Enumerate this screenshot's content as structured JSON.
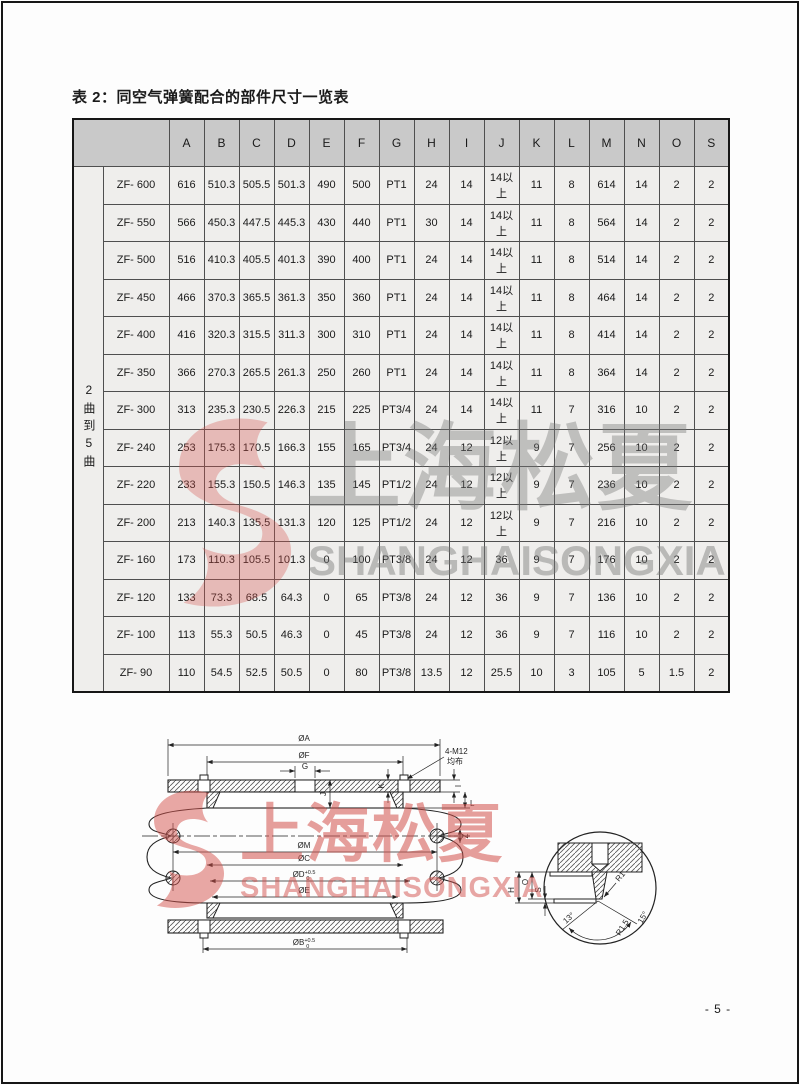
{
  "page": {
    "title": "表 2：同空气弹簧配合的部件尺寸一览表",
    "page_number": "- 5 -"
  },
  "table": {
    "row_group_label": "2曲到5曲",
    "columns": [
      "A",
      "B",
      "C",
      "D",
      "E",
      "F",
      "G",
      "H",
      "I",
      "J",
      "K",
      "L",
      "M",
      "N",
      "O",
      "S"
    ],
    "rows": [
      {
        "model": "ZF- 600",
        "values": [
          "616",
          "510.3",
          "505.5",
          "501.3",
          "490",
          "500",
          "PT1",
          "24",
          "14",
          "14以上",
          "11",
          "8",
          "614",
          "14",
          "2",
          "2"
        ]
      },
      {
        "model": "ZF- 550",
        "values": [
          "566",
          "450.3",
          "447.5",
          "445.3",
          "430",
          "440",
          "PT1",
          "30",
          "14",
          "14以上",
          "11",
          "8",
          "564",
          "14",
          "2",
          "2"
        ]
      },
      {
        "model": "ZF- 500",
        "values": [
          "516",
          "410.3",
          "405.5",
          "401.3",
          "390",
          "400",
          "PT1",
          "24",
          "14",
          "14以上",
          "11",
          "8",
          "514",
          "14",
          "2",
          "2"
        ]
      },
      {
        "model": "ZF- 450",
        "values": [
          "466",
          "370.3",
          "365.5",
          "361.3",
          "350",
          "360",
          "PT1",
          "24",
          "14",
          "14以上",
          "11",
          "8",
          "464",
          "14",
          "2",
          "2"
        ]
      },
      {
        "model": "ZF- 400",
        "values": [
          "416",
          "320.3",
          "315.5",
          "311.3",
          "300",
          "310",
          "PT1",
          "24",
          "14",
          "14以上",
          "11",
          "8",
          "414",
          "14",
          "2",
          "2"
        ]
      },
      {
        "model": "ZF- 350",
        "values": [
          "366",
          "270.3",
          "265.5",
          "261.3",
          "250",
          "260",
          "PT1",
          "24",
          "14",
          "14以上",
          "11",
          "8",
          "364",
          "14",
          "2",
          "2"
        ]
      },
      {
        "model": "ZF- 300",
        "values": [
          "313",
          "235.3",
          "230.5",
          "226.3",
          "215",
          "225",
          "PT3/4",
          "24",
          "14",
          "14以上",
          "11",
          "7",
          "316",
          "10",
          "2",
          "2"
        ]
      },
      {
        "model": "ZF- 240",
        "values": [
          "253",
          "175.3",
          "170.5",
          "166.3",
          "155",
          "165",
          "PT3/4",
          "24",
          "12",
          "12以上",
          "9",
          "7",
          "256",
          "10",
          "2",
          "2"
        ]
      },
      {
        "model": "ZF- 220",
        "values": [
          "233",
          "155.3",
          "150.5",
          "146.3",
          "135",
          "145",
          "PT1/2",
          "24",
          "12",
          "12以上",
          "9",
          "7",
          "236",
          "10",
          "2",
          "2"
        ]
      },
      {
        "model": "ZF- 200",
        "values": [
          "213",
          "140.3",
          "135.5",
          "131.3",
          "120",
          "125",
          "PT1/2",
          "24",
          "12",
          "12以上",
          "9",
          "7",
          "216",
          "10",
          "2",
          "2"
        ]
      },
      {
        "model": "ZF- 160",
        "values": [
          "173",
          "110.3",
          "105.5",
          "101.3",
          "0",
          "100",
          "PT3/8",
          "24",
          "12",
          "36",
          "9",
          "7",
          "176",
          "10",
          "2",
          "2"
        ]
      },
      {
        "model": "ZF- 120",
        "values": [
          "133",
          "73.3",
          "68.5",
          "64.3",
          "0",
          "65",
          "PT3/8",
          "24",
          "12",
          "36",
          "9",
          "7",
          "136",
          "10",
          "2",
          "2"
        ]
      },
      {
        "model": "ZF- 100",
        "values": [
          "113",
          "55.3",
          "50.5",
          "46.3",
          "0",
          "45",
          "PT3/8",
          "24",
          "12",
          "36",
          "9",
          "7",
          "116",
          "10",
          "2",
          "2"
        ]
      },
      {
        "model": "ZF- 90",
        "values": [
          "110",
          "54.5",
          "52.5",
          "50.5",
          "0",
          "80",
          "PT3/8",
          "13.5",
          "12",
          "25.5",
          "10",
          "3",
          "105",
          "5",
          "1.5",
          "2"
        ]
      }
    ]
  },
  "watermark": {
    "cn_text": "上海松夏",
    "en_text": "SHANGHAISONGXIA",
    "red": "#d5534d",
    "gray": "#9a9a9a"
  },
  "diagram": {
    "main": {
      "dia_a": "ØA",
      "dia_f": "ØF",
      "g": "G",
      "bolt_label": "4-M12",
      "bolt_label2": "均布",
      "j": "J",
      "k": "K",
      "i": "I",
      "l": "L",
      "z": "Z",
      "dia_m": "ØM",
      "dia_c": "ØC",
      "dia_d_base": "ØD",
      "dia_d_sup": "+0.5",
      "dia_d_sub": "0",
      "dia_e": "ØE",
      "dia_b_base": "ØB",
      "dia_b_sup": "+0.5",
      "dia_b_sub": "0"
    },
    "detail": {
      "h": "H",
      "o": "O",
      "s": "S",
      "r1": "R1",
      "r15": "R1.5",
      "deg15": "15°",
      "deg13": "13°"
    }
  }
}
